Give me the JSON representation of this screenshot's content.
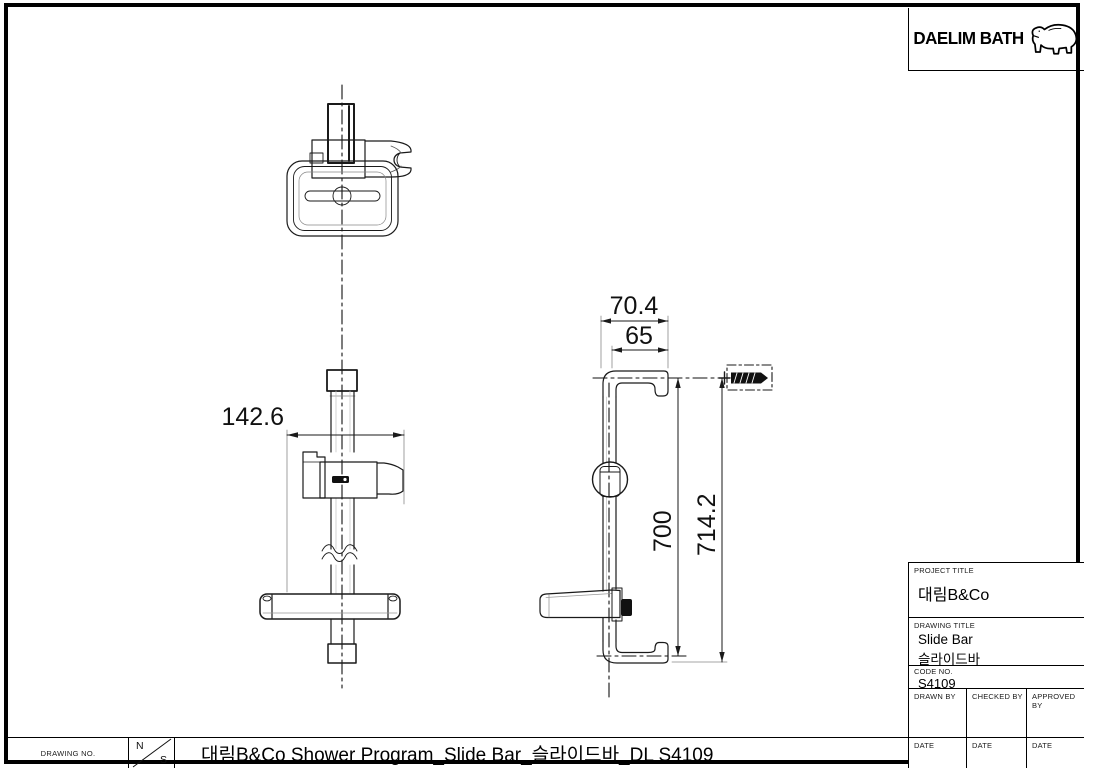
{
  "sheet": {
    "background": "#ffffff",
    "line_color": "#1a1a1a"
  },
  "logo": {
    "brand": "DAELIM BATH",
    "bear_icon": "polar-bear-icon"
  },
  "front_view": {
    "width_dim": "142.6"
  },
  "side_view": {
    "outer_depth_dim": "70.4",
    "inner_depth_dim": "65",
    "bar_length_dim": "700",
    "total_length_dim": "714.2"
  },
  "title_block": {
    "project_title_label": "PROJECT TITLE",
    "project_title": "대림B&Co",
    "drawing_title_label": "DRAWING TITLE",
    "drawing_title_line1": "Slide Bar",
    "drawing_title_line2": "슬라이드바",
    "code_no_label": "CODE NO.",
    "code_no": "S4109",
    "drawn_by_label": "DRAWN BY",
    "checked_by_label": "CHECKED BY",
    "approved_by_label": "APPROVED BY",
    "date_label": "DATE"
  },
  "footer": {
    "drawing_no_label": "DRAWING NO.",
    "scale_numerator": "N",
    "scale_denominator": "S",
    "title": "대림B&Co Shower Program_Slide Bar_슬라이드바_DL S4109"
  }
}
